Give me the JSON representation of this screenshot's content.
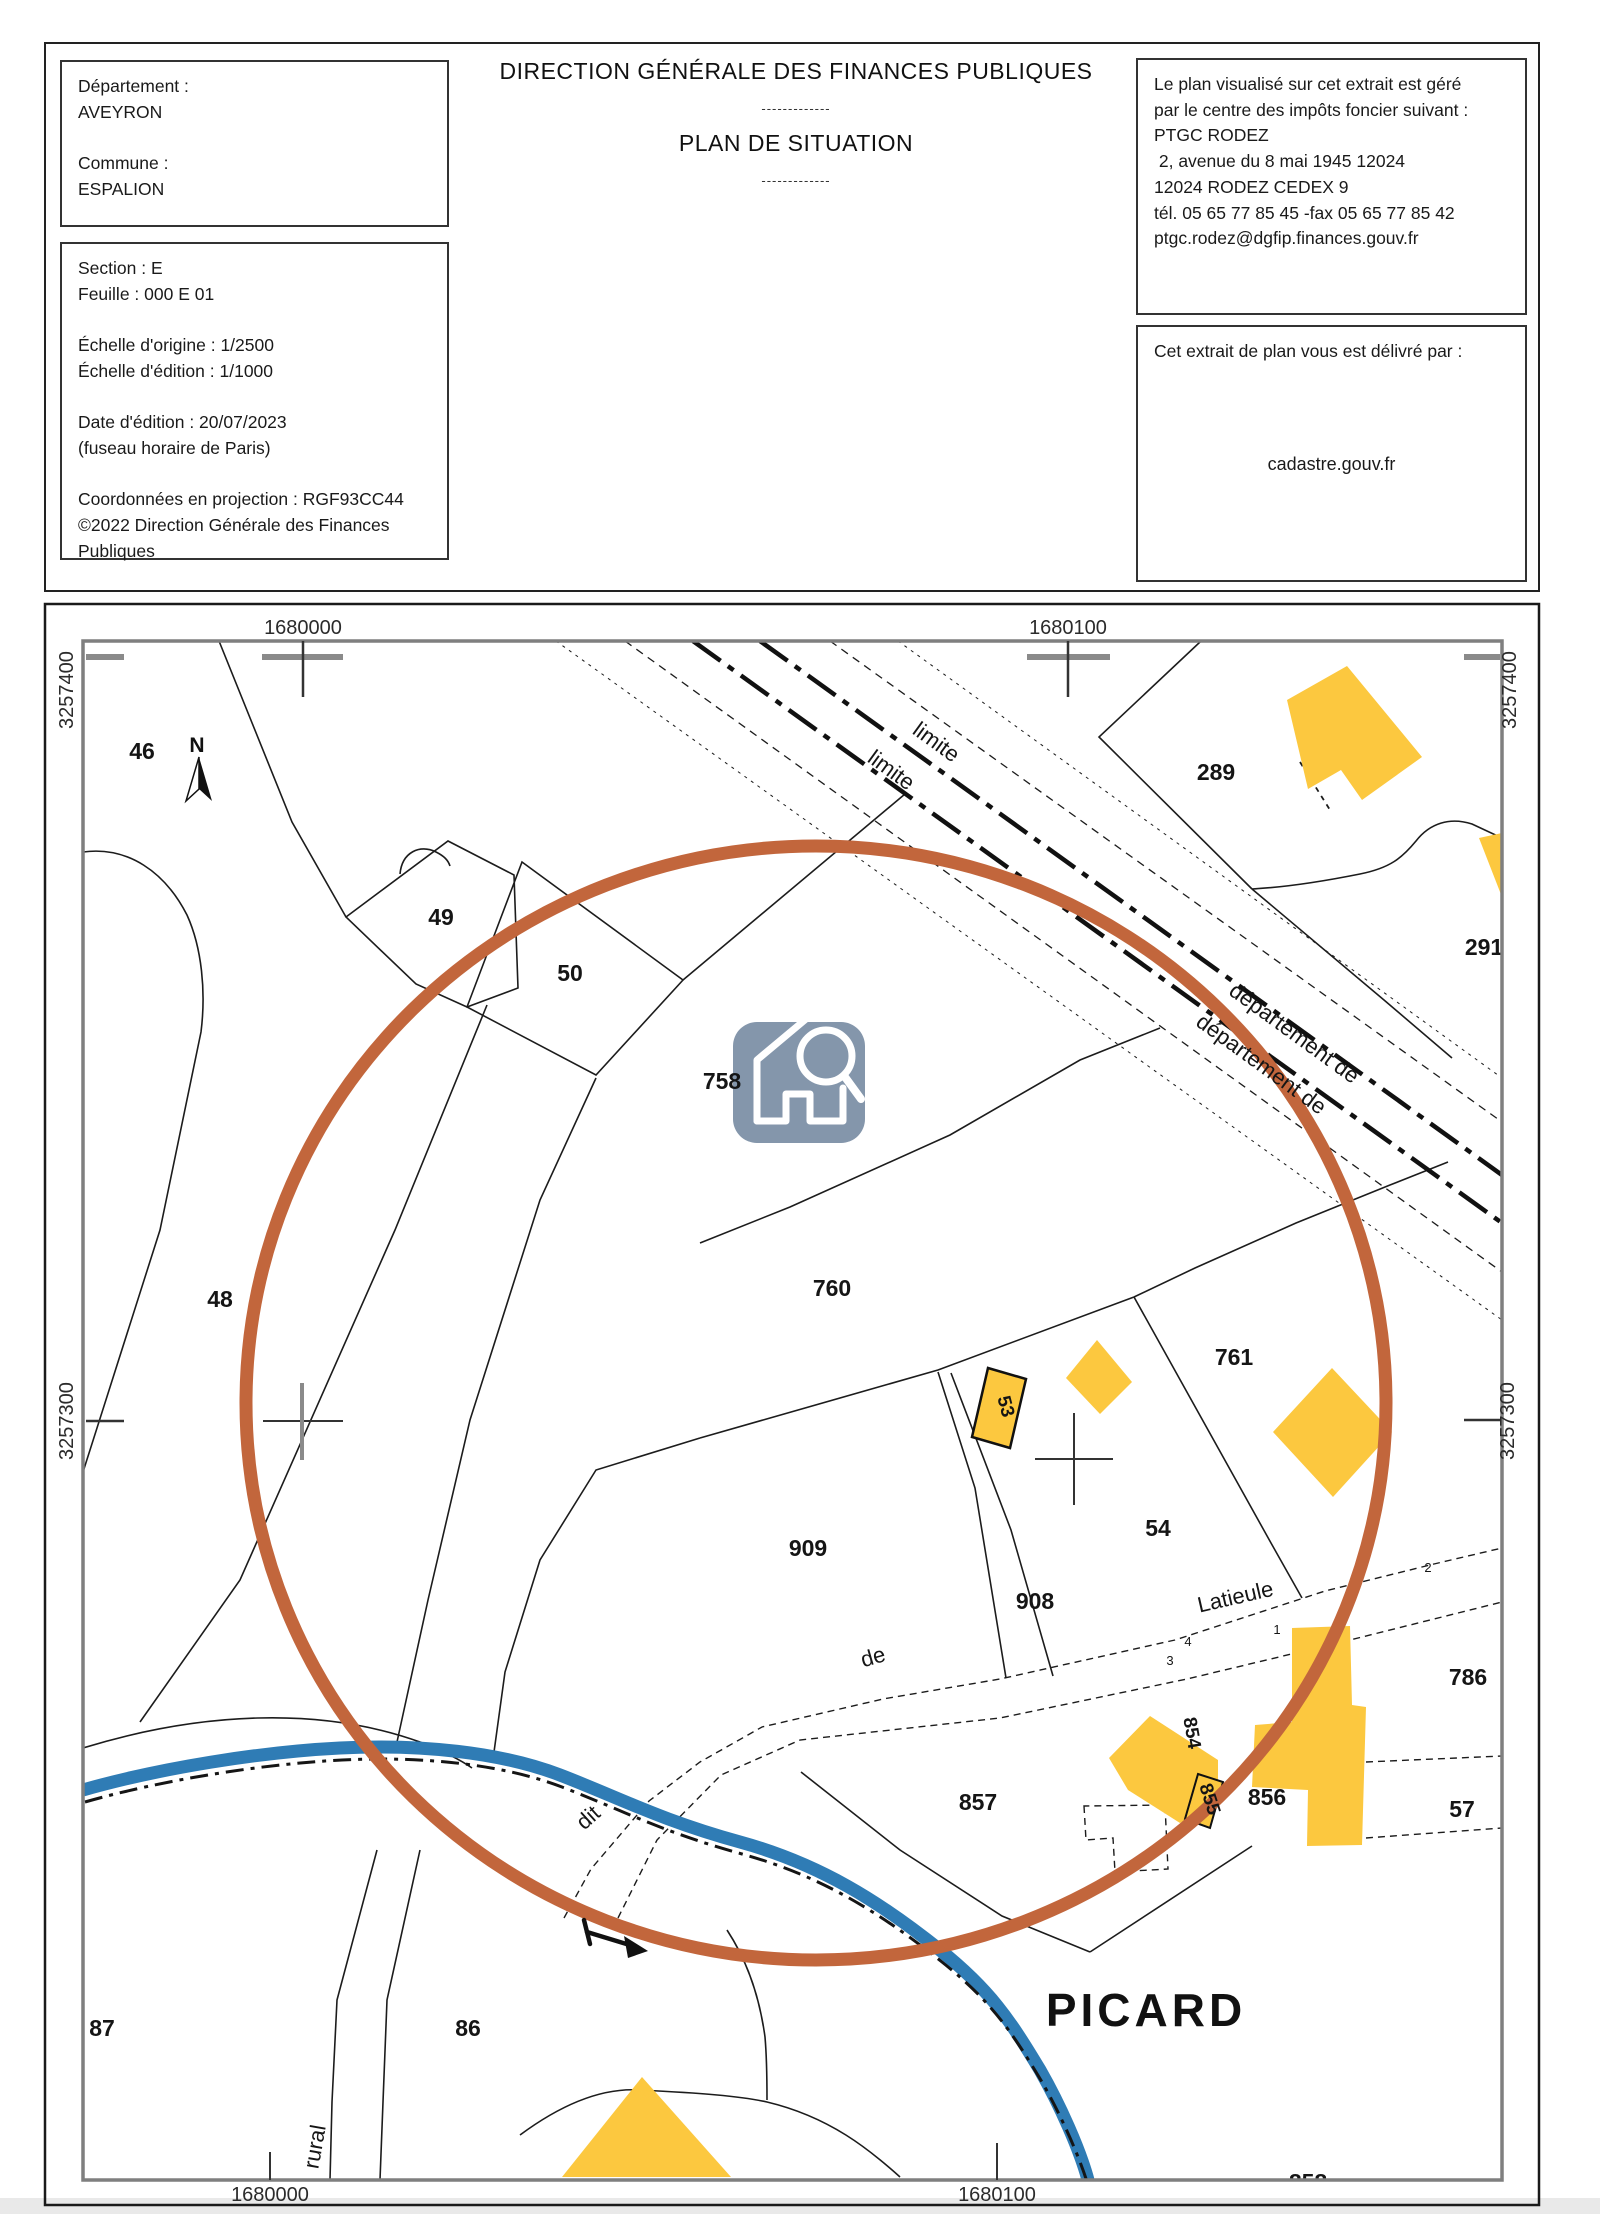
{
  "header": {
    "id_lines": [
      "Département :",
      "AVEYRON",
      "",
      "Commune :",
      "ESPALION"
    ],
    "info_lines": [
      "Section : E",
      "Feuille : 000 E 01",
      "",
      "Échelle d'origine : 1/2500",
      "Échelle d'édition : 1/1000",
      "",
      "Date d'édition : 20/07/2023",
      "(fuseau horaire de Paris)",
      "",
      "Coordonnées en projection : RGF93CC44",
      "©2022 Direction Générale des Finances",
      "Publiques"
    ],
    "title": "DIRECTION GÉNÉRALE DES FINANCES PUBLIQUES",
    "divider": "-------------",
    "subtitle": "PLAN DE SITUATION",
    "office_lines": [
      "Le plan visualisé sur cet extrait est géré",
      "par le centre des impôts foncier suivant :",
      "PTGC RODEZ",
      " 2, avenue du 8 mai 1945 12024",
      "12024 RODEZ CEDEX 9",
      "tél. 05 65 77 85 45 -fax 05 65 77 85 42",
      "ptgc.rodez@dgfip.finances.gouv.fr"
    ],
    "delivery_label": "Cet extrait de plan vous est délivré par :",
    "delivery_site": "cadastre.gouv.fr"
  },
  "map": {
    "grid": {
      "x_left": "1680000",
      "x_right": "1680100",
      "y_top": "3257400",
      "y_mid": "3257300"
    },
    "north_label": "N",
    "place": "PICARD",
    "parcels": [
      {
        "id": "46"
      },
      {
        "id": "49"
      },
      {
        "id": "50"
      },
      {
        "id": "758"
      },
      {
        "id": "48"
      },
      {
        "id": "760"
      },
      {
        "id": "761"
      },
      {
        "id": "53"
      },
      {
        "id": "54"
      },
      {
        "id": "909"
      },
      {
        "id": "908"
      },
      {
        "id": "857"
      },
      {
        "id": "854"
      },
      {
        "id": "855"
      },
      {
        "id": "856"
      },
      {
        "id": "289"
      },
      {
        "id": "291"
      },
      {
        "id": "786"
      },
      {
        "id": "57"
      },
      {
        "id": "87"
      },
      {
        "id": "86"
      },
      {
        "id": "858"
      }
    ],
    "roads": {
      "limite": "limite",
      "departement": "département de",
      "dit": "dit",
      "de": "de",
      "latieule": "Latieule",
      "rural": "rural",
      "n1": "1",
      "n2": "2",
      "n3": "3",
      "n4": "4"
    },
    "colors": {
      "highlight": "#c2663c",
      "water": "#2f7cb5",
      "building": "#fcc83f",
      "icon_bg": "#8496ab",
      "neatline": "#7f7f7f"
    }
  }
}
